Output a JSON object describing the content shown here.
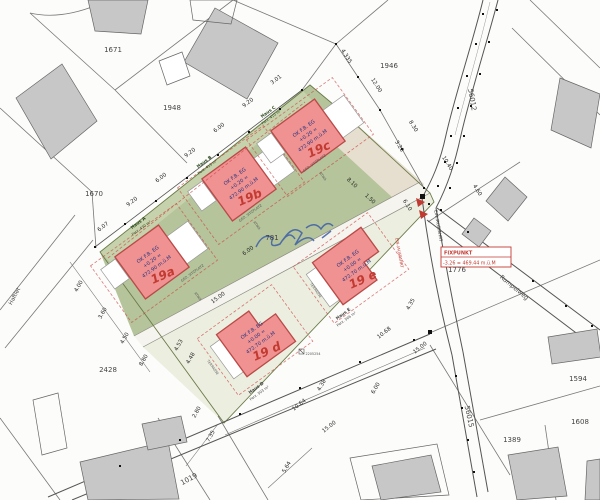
{
  "map": {
    "title": "Lageplan Neubau Haus A-E",
    "colors": {
      "site_green": "#b5c49a",
      "garden_band": "#c6d2ab",
      "access_beige": "#e6dece",
      "road_strip": "#f6f4ee",
      "southeast_pale": "#ecefe0",
      "house_pink": "#f19292",
      "house_border": "#b94a48",
      "existing_building_gray": "#c7c7c7",
      "red_annotation": "#c23b32",
      "blue_annotation": "#3d5fa8",
      "line_gray": "#777777"
    },
    "fixpunkt": {
      "title": "FIXPUNKT",
      "value": "-3.26 = 469.44 m.ü.M"
    },
    "parcels": [
      {
        "id": "1671",
        "x": 113,
        "y": 52,
        "r": 0
      },
      {
        "id": "1948",
        "x": 172,
        "y": 110,
        "r": 0
      },
      {
        "id": "1946",
        "x": 389,
        "y": 68,
        "r": 0
      },
      {
        "id": "1670",
        "x": 94,
        "y": 196,
        "r": 0
      },
      {
        "id": "2428",
        "x": 108,
        "y": 372,
        "r": 0
      },
      {
        "id": "781",
        "x": 272,
        "y": 240,
        "r": 0
      },
      {
        "id": "1776",
        "x": 457,
        "y": 272,
        "r": 0
      },
      {
        "id": "1594",
        "x": 578,
        "y": 381,
        "r": 0
      },
      {
        "id": "1608",
        "x": 580,
        "y": 424,
        "r": 0
      },
      {
        "id": "1389",
        "x": 512,
        "y": 442,
        "r": 0
      },
      {
        "id": "1019",
        "x": 190,
        "y": 481,
        "r": -28
      },
      {
        "id": "56012",
        "x": 470,
        "y": 100,
        "r": 80
      },
      {
        "id": "56015",
        "x": 467,
        "y": 417,
        "r": 78
      }
    ],
    "dimensions": [
      {
        "t": "6.07",
        "x": 104,
        "y": 228,
        "r": -38
      },
      {
        "t": "9.20",
        "x": 133,
        "y": 203,
        "r": -38
      },
      {
        "t": "6.00",
        "x": 162,
        "y": 179,
        "r": -38
      },
      {
        "t": "9.20",
        "x": 191,
        "y": 154,
        "r": -38
      },
      {
        "t": "6.00",
        "x": 220,
        "y": 129,
        "r": -38
      },
      {
        "t": "9.20",
        "x": 249,
        "y": 104,
        "r": -38
      },
      {
        "t": "3.01",
        "x": 277,
        "y": 81,
        "r": -38
      },
      {
        "t": "4.335",
        "x": 345,
        "y": 57,
        "r": 58
      },
      {
        "t": "12.00",
        "x": 375,
        "y": 86,
        "r": 58
      },
      {
        "t": "8.30",
        "x": 412,
        "y": 127,
        "r": 58
      },
      {
        "t": "3.28",
        "x": 398,
        "y": 147,
        "r": 58
      },
      {
        "t": "10.40",
        "x": 446,
        "y": 164,
        "r": 58
      },
      {
        "t": "4.60",
        "x": 476,
        "y": 191,
        "r": 58
      },
      {
        "t": "6.10",
        "x": 406,
        "y": 206,
        "r": 58
      },
      {
        "t": "8.10",
        "x": 351,
        "y": 184,
        "r": 43
      },
      {
        "t": "1.50",
        "x": 369,
        "y": 200,
        "r": 43
      },
      {
        "t": "6.00",
        "x": 249,
        "y": 252,
        "r": -36
      },
      {
        "t": "15.00",
        "x": 219,
        "y": 299,
        "r": -36
      },
      {
        "t": "4.00",
        "x": 80,
        "y": 287,
        "r": -60
      },
      {
        "t": "3.60",
        "x": 104,
        "y": 314,
        "r": -60
      },
      {
        "t": "4.50",
        "x": 126,
        "y": 339,
        "r": -60
      },
      {
        "t": "8.80",
        "x": 145,
        "y": 361,
        "r": -60
      },
      {
        "t": "4.53",
        "x": 180,
        "y": 346,
        "r": -60
      },
      {
        "t": "4.48",
        "x": 192,
        "y": 359,
        "r": -60
      },
      {
        "t": "2.80",
        "x": 198,
        "y": 413,
        "r": -60
      },
      {
        "t": "7.35",
        "x": 212,
        "y": 437,
        "r": -60
      },
      {
        "t": "5.64",
        "x": 288,
        "y": 468,
        "r": -60
      },
      {
        "t": "10.64",
        "x": 300,
        "y": 406,
        "r": -38
      },
      {
        "t": "4.38",
        "x": 323,
        "y": 386,
        "r": -60
      },
      {
        "t": "6.00",
        "x": 377,
        "y": 389,
        "r": -60
      },
      {
        "t": "15.00",
        "x": 330,
        "y": 428,
        "r": -38
      },
      {
        "t": "15.00",
        "x": 421,
        "y": 349,
        "r": -38
      },
      {
        "t": "10.68",
        "x": 385,
        "y": 334,
        "r": -38
      },
      {
        "t": "4.35",
        "x": 412,
        "y": 305,
        "r": -60
      }
    ],
    "streets": [
      {
        "name": "Rumpelweg",
        "x": 513,
        "y": 289,
        "r": 40,
        "size": 6,
        "color": "#444444"
      },
      {
        "name": "Haftlet",
        "x": 16,
        "y": 297,
        "r": -62,
        "size": 5.5,
        "color": "#444444"
      },
      {
        "name": "EIN-/AUSFAHRT",
        "x": 437,
        "y": 226,
        "r": 80,
        "size": 4.2,
        "color": "#333333"
      },
      {
        "name": "EIN-/AUSFAHRT",
        "x": 398,
        "y": 253,
        "r": 80,
        "size": 4,
        "color": "#c23b32"
      }
    ],
    "haus_labels": [
      {
        "name": "Haus A",
        "area": "Parz. 430 m²",
        "x": 139,
        "y": 224,
        "r": -36,
        "color": "#2c4a1f"
      },
      {
        "name": "Haus B",
        "area": "Parz. 415 m²",
        "x": 205,
        "y": 163,
        "r": -36,
        "color": "#2c4a1f"
      },
      {
        "name": "Haus C",
        "area": "Parz. 410 m²",
        "x": 269,
        "y": 113,
        "r": -36,
        "color": "#2c4a1f"
      },
      {
        "name": "Haus D",
        "area": "Parz. 503 m²",
        "x": 257,
        "y": 389,
        "r": -36,
        "color": "#444444"
      },
      {
        "name": "Haus E",
        "area": "Parz. 566 m²",
        "x": 344,
        "y": 315,
        "r": -36,
        "color": "#444444"
      }
    ],
    "labels": [
      {
        "t": "GED. SITZPLATZ",
        "x": 193,
        "y": 274,
        "r": -36
      },
      {
        "t": "GED. SITZPLATZ",
        "x": 251,
        "y": 214,
        "r": -36
      },
      {
        "t": "GED. SITZPLATZ",
        "x": 315,
        "y": 164,
        "r": -36
      },
      {
        "t": "ATIKA",
        "x": 197,
        "y": 297,
        "r": 54
      },
      {
        "t": "ATIKA",
        "x": 256,
        "y": 226,
        "r": 54
      },
      {
        "t": "ATIKA",
        "x": 322,
        "y": 177,
        "r": 54
      },
      {
        "t": "TERRASSE",
        "x": 212,
        "y": 368,
        "r": 54
      },
      {
        "t": "TERRASSE",
        "x": 315,
        "y": 291,
        "r": 54
      },
      {
        "t": "2205254",
        "x": 313,
        "y": 355,
        "r": 0
      }
    ],
    "houses": [
      {
        "key": "haus-a",
        "type": "top",
        "cx": 152,
        "cy": 262,
        "line1": "OK F.B. EG",
        "line2": "+0.20 =",
        "line3": "472.90 m.ü.M",
        "hand": "19a"
      },
      {
        "key": "haus-b",
        "type": "top",
        "cx": 239,
        "cy": 184,
        "line1": "OK F.B. EG",
        "line2": "+0.20 =",
        "line3": "472.90 m.ü.M",
        "hand": "19b"
      },
      {
        "key": "haus-c",
        "type": "top",
        "cx": 308,
        "cy": 136,
        "line1": "OK F.B. EG",
        "line2": "+0.20 =",
        "line3": "472.90 m.ü.M",
        "hand": "19c"
      },
      {
        "key": "haus-d",
        "type": "bottomD",
        "cx": 256,
        "cy": 338,
        "line1": "OK F.B. EG",
        "line2": "+0.00 =",
        "line3": "472.70 m.ü.M",
        "hand": "19 d"
      },
      {
        "key": "haus-e",
        "type": "bottomE",
        "cx": 352,
        "cy": 266,
        "line1": "OK F.B. EG",
        "line2": "+0.00 =",
        "line3": "472.70 m.ü.M",
        "hand": "19 e"
      }
    ]
  }
}
